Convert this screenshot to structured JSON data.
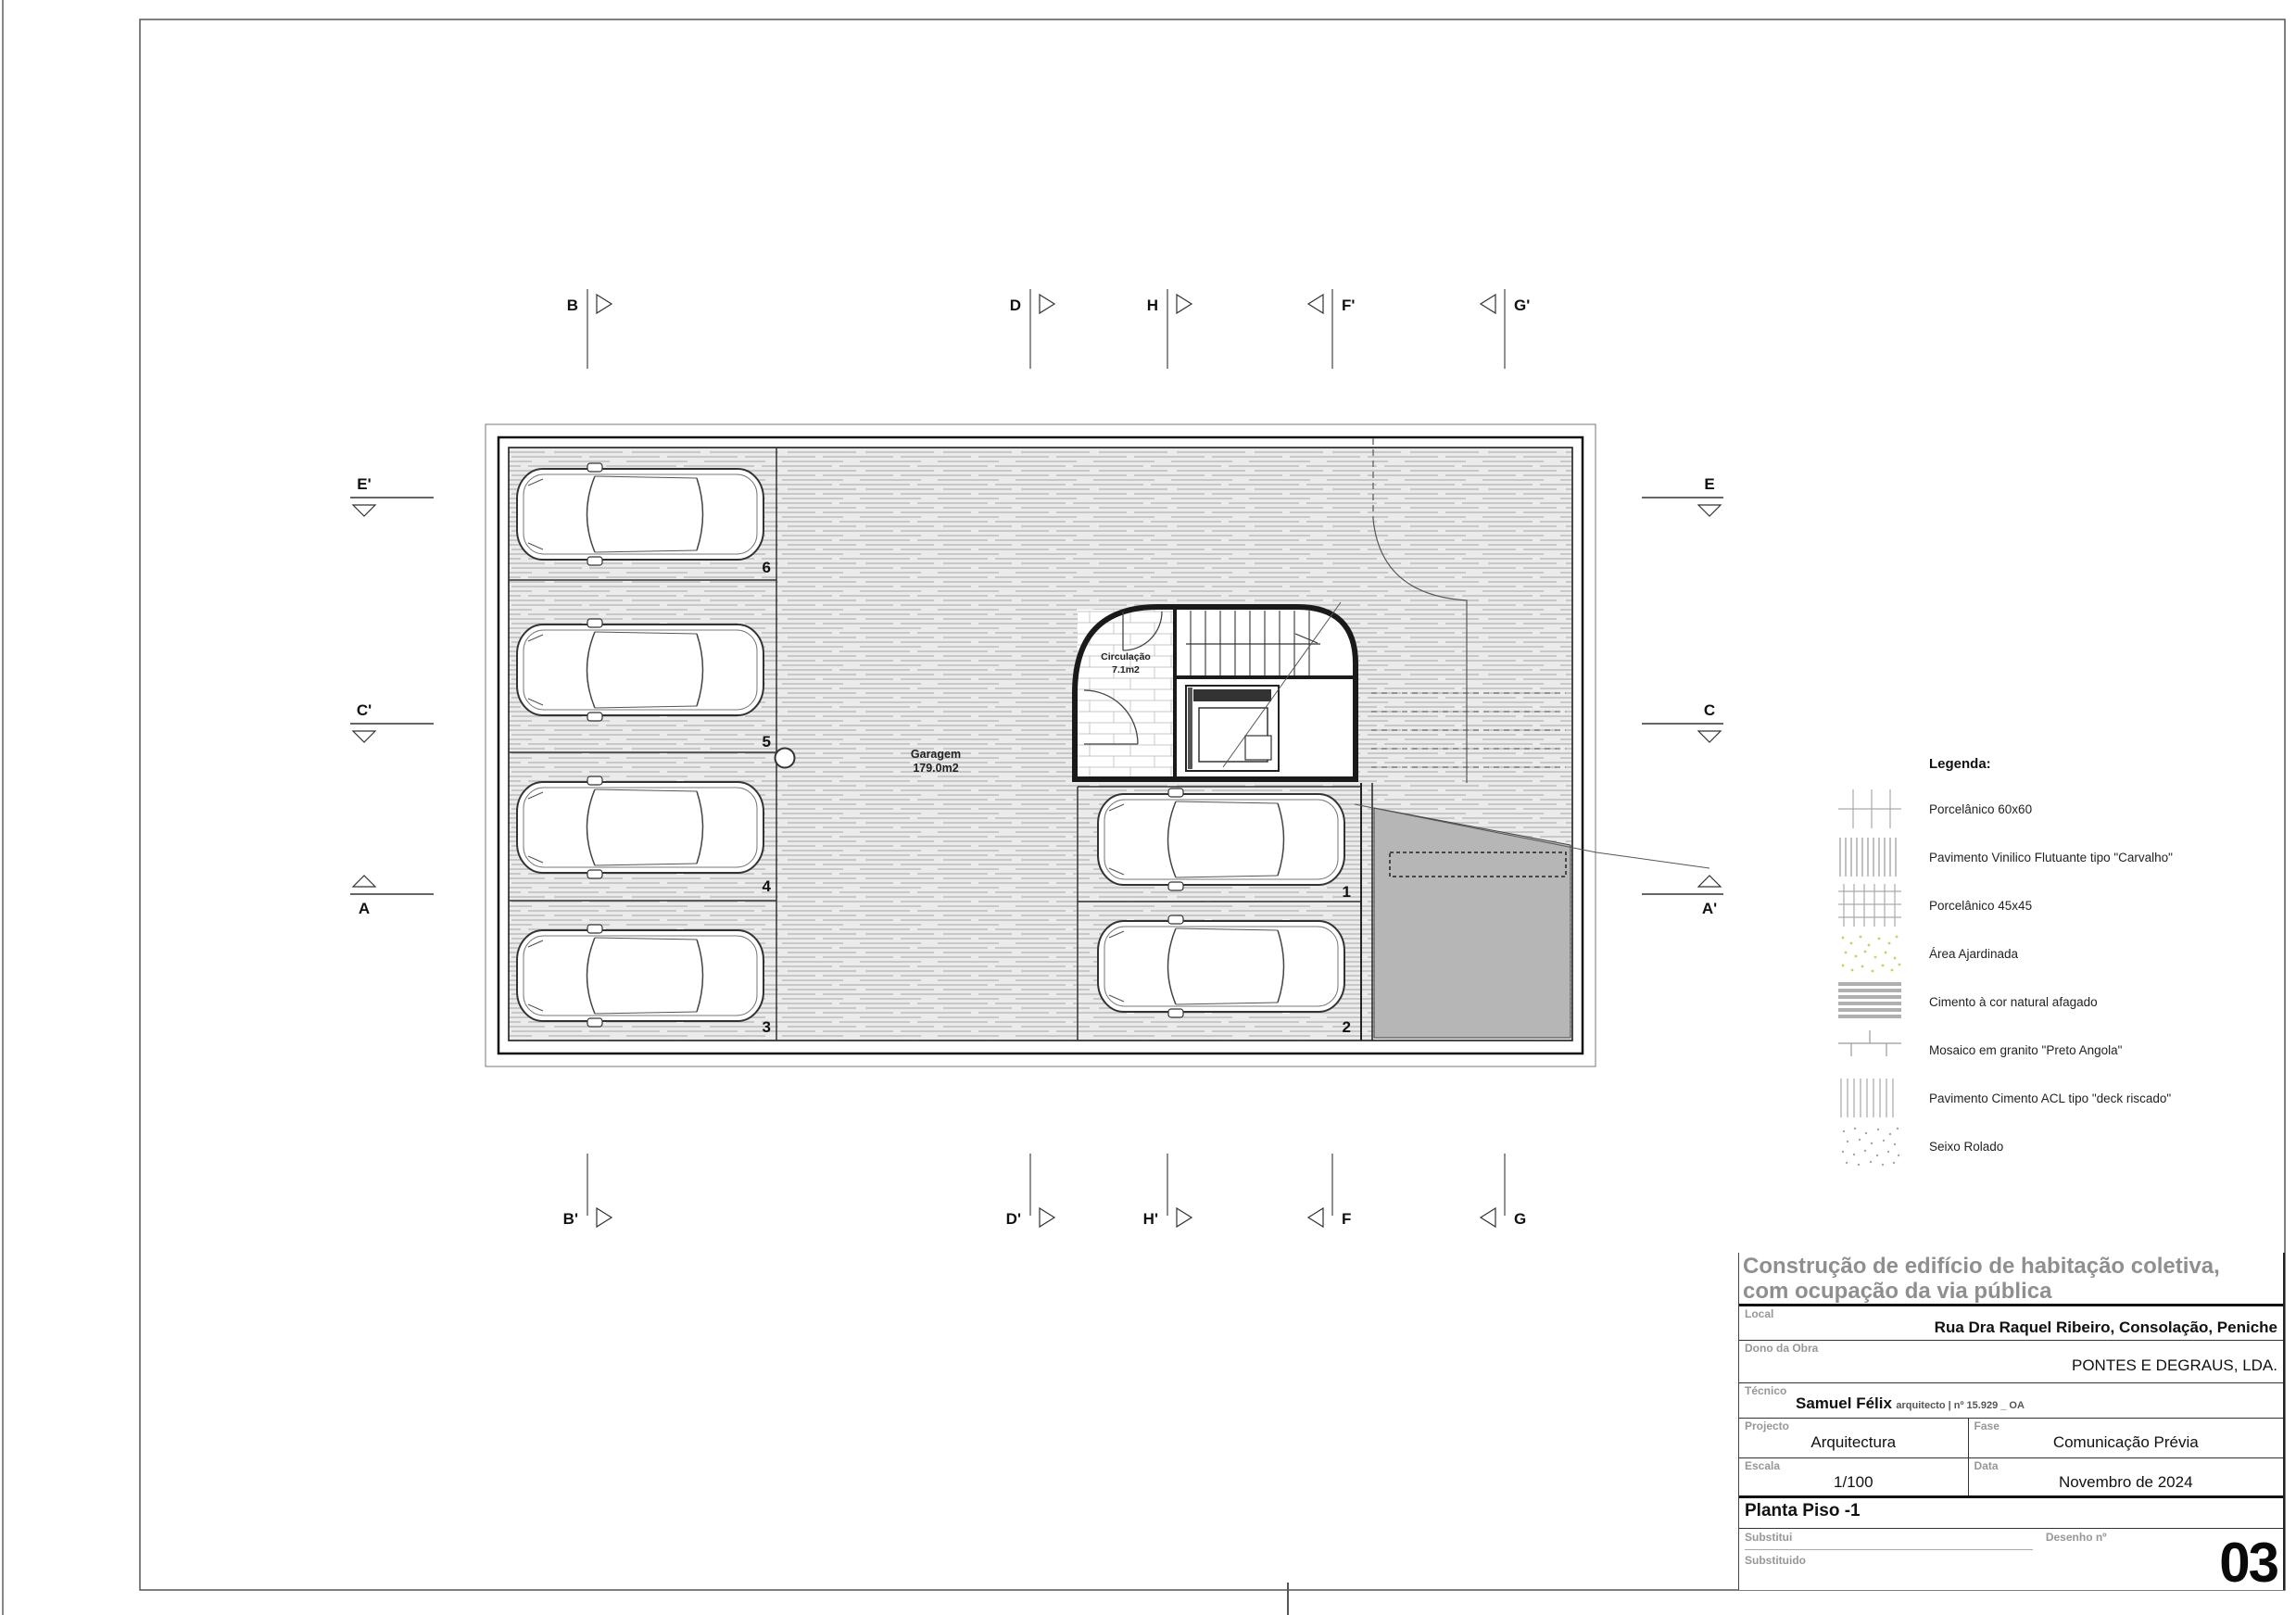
{
  "drawing": {
    "garage_label": "Garagem",
    "garage_area": "179.0m2",
    "circulation_label": "Circulação",
    "circulation_area": "7.1m2",
    "stalls": [
      "6",
      "5",
      "4",
      "3",
      "1",
      "2"
    ],
    "markers": {
      "top": [
        "B",
        "D",
        "H",
        "F'",
        "G'"
      ],
      "bottom": [
        "B'",
        "D'",
        "H'",
        "F",
        "G"
      ],
      "left": [
        "E'",
        "C'",
        "A"
      ],
      "right": [
        "E",
        "C",
        "A'"
      ]
    }
  },
  "legend": {
    "title": "Legenda:",
    "items": [
      {
        "label": "Porcelânico 60x60",
        "swatch": "grid-sparse"
      },
      {
        "label": "Pavimento Vinilico Flutuante tipo \"Carvalho\"",
        "swatch": "vertical-lines"
      },
      {
        "label": "Porcelânico 45x45",
        "swatch": "grid-dense"
      },
      {
        "label": "Área Ajardinada",
        "swatch": "green-speckles"
      },
      {
        "label": "Cimento à cor natural afagado",
        "swatch": "gray-stripes"
      },
      {
        "label": "Mosaico em granito \"Preto Angola\"",
        "swatch": "tick-lines"
      },
      {
        "label": "Pavimento Cimento ACL tipo \"deck riscado\"",
        "swatch": "light-vertical-lines"
      },
      {
        "label": "Seixo Rolado",
        "swatch": "gray-speckles"
      }
    ]
  },
  "title_block": {
    "project_title_line1": "Construção de edifício de habitação coletiva,",
    "project_title_line2": "com ocupação da via pública",
    "local_label": "Local",
    "local_value": "Rua Dra Raquel Ribeiro, Consolação, Peniche",
    "owner_label": "Dono da Obra",
    "owner_value": "PONTES E DEGRAUS, LDA.",
    "technician_label": "Técnico",
    "technician_name": "Samuel Félix",
    "technician_title": "arquitecto | nº 15.929 _ OA",
    "project_label": "Projecto",
    "project_value": "Arquitectura",
    "phase_label": "Fase",
    "phase_value": "Comunicação Prévia",
    "scale_label": "Escala",
    "scale_value": "1/100",
    "date_label": "Data",
    "date_value": "Novembro de 2024",
    "sheet_name": "Planta Piso -1",
    "replaces_label": "Substitui",
    "replaced_label": "Substituido",
    "drawing_no_label": "Desenho nº",
    "drawing_no_value": "03"
  },
  "colors": {
    "line_dark": "#1a1a1a",
    "line_mid": "#555555",
    "hatch_bg": "#ebebeb",
    "hatch_line": "#bdbdbd",
    "ramp_gray": "#b6b6b6",
    "title_gray": "#8f8f8f",
    "garden_green": "#c0d468"
  }
}
